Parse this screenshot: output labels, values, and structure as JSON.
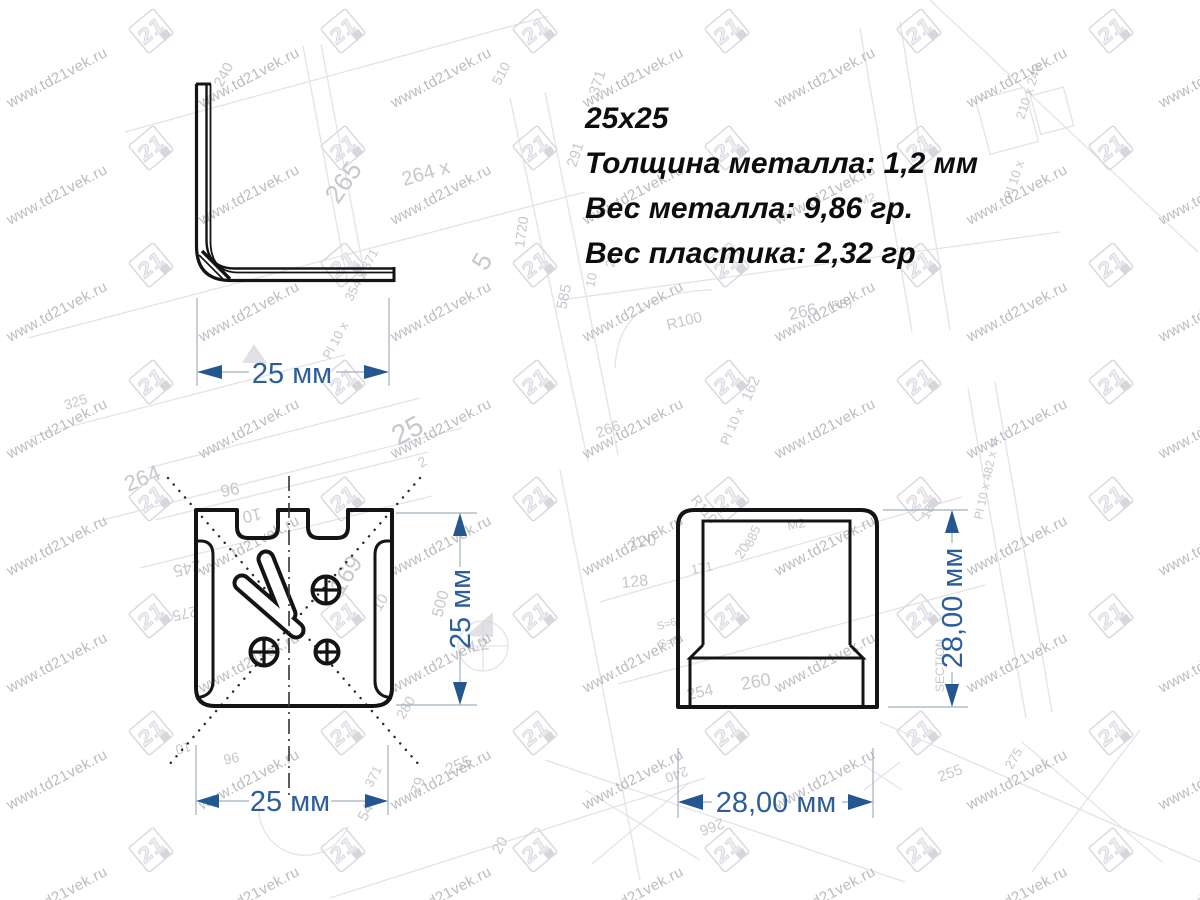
{
  "specs": {
    "size": "25x25",
    "metal_thickness": "Толщина металла: 1,2 мм",
    "metal_weight": "Вес металла: 9,86 гр.",
    "plastic_weight": "Вес пластика: 2,32 гр"
  },
  "dimensions": {
    "side_width": "25 мм",
    "front_height": "25 мм",
    "front_width": "25 мм",
    "cap_height": "28,00 мм",
    "cap_width": "28,00 мм"
  },
  "watermark": {
    "url": "www.td21vek.ru",
    "logo": "21"
  },
  "colors": {
    "dimension_text": "#2d5e99",
    "dimension_arrow": "#24568f",
    "drawing_line": "#141414",
    "watermark_text": "#ababb2",
    "watermark_logo": "#d7d7dd",
    "blueprint_line": "#e3e3e9",
    "background_label": "#c7c7cd"
  },
  "background_labels": [
    {
      "t": "240",
      "x": 222,
      "y": 88,
      "r": -62,
      "s": 15
    },
    {
      "t": "510",
      "x": 500,
      "y": 86,
      "r": -62,
      "s": 14
    },
    {
      "t": "371",
      "x": 598,
      "y": 96,
      "r": -72,
      "s": 15
    },
    {
      "t": "291",
      "x": 576,
      "y": 168,
      "r": -72,
      "s": 15
    },
    {
      "t": "265",
      "x": 338,
      "y": 205,
      "r": -55,
      "s": 26
    },
    {
      "t": "264 x",
      "x": 404,
      "y": 186,
      "r": -16,
      "s": 20
    },
    {
      "t": "210 x 240",
      "x": 1024,
      "y": 120,
      "r": -72,
      "s": 13
    },
    {
      "t": "Pl 10 x",
      "x": 1012,
      "y": 200,
      "r": -72,
      "s": 13
    },
    {
      "t": "354 x 371",
      "x": 352,
      "y": 302,
      "r": -62,
      "s": 13
    },
    {
      "t": "Pl 10 x",
      "x": 330,
      "y": 360,
      "r": -62,
      "s": 13
    },
    {
      "t": "96",
      "x": 238,
      "y": 482,
      "r": 168,
      "s": 17
    },
    {
      "t": "10",
      "x": 260,
      "y": 508,
      "r": 168,
      "s": 17
    },
    {
      "t": "245",
      "x": 200,
      "y": 560,
      "r": 168,
      "s": 17
    },
    {
      "t": "275",
      "x": 196,
      "y": 606,
      "r": 168,
      "s": 15
    },
    {
      "t": "325",
      "x": 66,
      "y": 410,
      "r": -18,
      "s": 14
    },
    {
      "t": "169",
      "x": 342,
      "y": 596,
      "r": -58,
      "s": 24
    },
    {
      "t": "10",
      "x": 380,
      "y": 612,
      "r": -58,
      "s": 15
    },
    {
      "t": "25",
      "x": 398,
      "y": 446,
      "r": -28,
      "s": 28
    },
    {
      "t": "2",
      "x": 421,
      "y": 468,
      "r": -28,
      "s": 14
    },
    {
      "t": "264",
      "x": 128,
      "y": 492,
      "r": -22,
      "s": 22
    },
    {
      "t": "500",
      "x": 442,
      "y": 618,
      "r": -75,
      "s": 16
    },
    {
      "t": "L2",
      "x": 472,
      "y": 652,
      "r": -10,
      "s": 16
    },
    {
      "t": "79",
      "x": 420,
      "y": 795,
      "r": -72,
      "s": 15
    },
    {
      "t": "20",
      "x": 500,
      "y": 855,
      "r": -60,
      "s": 15
    },
    {
      "t": "54",
      "x": 366,
      "y": 822,
      "r": -62,
      "s": 15
    },
    {
      "t": "371",
      "x": 372,
      "y": 788,
      "r": -62,
      "s": 13
    },
    {
      "t": "255",
      "x": 448,
      "y": 775,
      "r": -22,
      "s": 16
    },
    {
      "t": "280",
      "x": 404,
      "y": 720,
      "r": -60,
      "s": 14
    },
    {
      "t": "1720",
      "x": 524,
      "y": 248,
      "r": -82,
      "s": 14
    },
    {
      "t": "5",
      "x": 486,
      "y": 272,
      "r": -60,
      "s": 26
    },
    {
      "t": "585",
      "x": 566,
      "y": 310,
      "r": -78,
      "s": 15
    },
    {
      "t": "10",
      "x": 594,
      "y": 288,
      "r": -78,
      "s": 13
    },
    {
      "t": "25",
      "x": 614,
      "y": 268,
      "r": -78,
      "s": 13
    },
    {
      "t": "R100",
      "x": 668,
      "y": 330,
      "r": -14,
      "s": 15
    },
    {
      "t": "(RS)",
      "x": 828,
      "y": 310,
      "r": -8,
      "s": 12
    },
    {
      "t": "266",
      "x": 790,
      "y": 320,
      "r": -12,
      "s": 17
    },
    {
      "t": "162",
      "x": 750,
      "y": 402,
      "r": -66,
      "s": 15
    },
    {
      "t": "Pl 10 x",
      "x": 728,
      "y": 446,
      "r": -66,
      "s": 13
    },
    {
      "t": "885",
      "x": 752,
      "y": 548,
      "r": -66,
      "s": 13
    },
    {
      "t": "R110",
      "x": 690,
      "y": 500,
      "r": 50,
      "s": 14
    },
    {
      "t": "20",
      "x": 742,
      "y": 560,
      "r": -58,
      "s": 14
    },
    {
      "t": "120",
      "x": 630,
      "y": 548,
      "r": -6,
      "s": 16
    },
    {
      "t": "128",
      "x": 622,
      "y": 588,
      "r": -6,
      "s": 16
    },
    {
      "t": "SECTION",
      "x": 944,
      "y": 692,
      "r": -90,
      "s": 12
    },
    {
      "t": "Pl 10 x 482 x +l",
      "x": 982,
      "y": 520,
      "r": -78,
      "s": 12
    },
    {
      "t": "266",
      "x": 598,
      "y": 438,
      "r": -20,
      "s": 15
    },
    {
      "t": "М2",
      "x": 788,
      "y": 530,
      "r": -10,
      "s": 13
    },
    {
      "t": "254",
      "x": 688,
      "y": 700,
      "r": -12,
      "s": 16
    },
    {
      "t": "260",
      "x": 742,
      "y": 690,
      "r": -10,
      "s": 18
    },
    {
      "t": "240",
      "x": 686,
      "y": 766,
      "r": 160,
      "s": 14
    },
    {
      "t": "266",
      "x": 722,
      "y": 818,
      "r": 160,
      "s": 15
    },
    {
      "t": "171",
      "x": 692,
      "y": 574,
      "r": -10,
      "s": 13
    },
    {
      "t": "255",
      "x": 940,
      "y": 782,
      "r": -20,
      "s": 15
    },
    {
      "t": "275",
      "x": 1012,
      "y": 770,
      "r": -60,
      "s": 13
    },
    {
      "t": "18",
      "x": 928,
      "y": 520,
      "r": -62,
      "s": 13
    },
    {
      "t": "S=6",
      "x": 658,
      "y": 630,
      "r": -15,
      "s": 11
    },
    {
      "t": "S=6",
      "x": 660,
      "y": 648,
      "r": -15,
      "s": 11
    },
    {
      "t": "M2",
      "x": 860,
      "y": 205,
      "r": -15,
      "s": 12
    },
    {
      "t": "10",
      "x": 190,
      "y": 742,
      "r": 168,
      "s": 14
    },
    {
      "t": "96",
      "x": 238,
      "y": 752,
      "r": 168,
      "s": 14
    }
  ]
}
